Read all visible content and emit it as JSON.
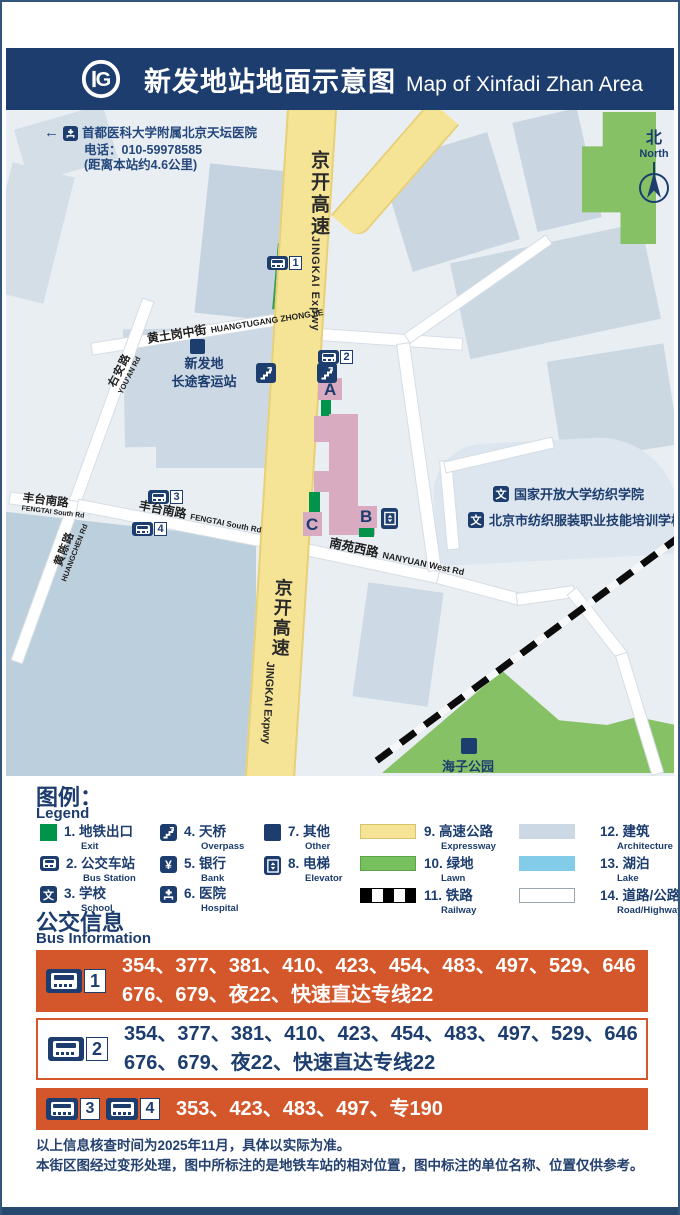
{
  "colors": {
    "navy": "#1c3d6e",
    "orange": "#d4562b",
    "expressway_yellow": "#f6e496",
    "lawn_green": "#76c05e",
    "exit_green": "#00944a",
    "building_gray": "#ccd8e3",
    "lake_blue": "#82cbe9",
    "station_pink": "#d9abc0"
  },
  "header": {
    "title_zh": "新发地站地面示意图",
    "title_en": "Map of Xinfadi Zhan Area",
    "logo": "beijing-subway-logo"
  },
  "map": {
    "info_box": {
      "line1": "首都医科大学附属北京天坛医院",
      "line2": "电话：010-59978585",
      "line3": "(距离本站约4.6公里)"
    },
    "north": {
      "zh": "北",
      "en": "North"
    },
    "expressway": {
      "zh": "京开高速",
      "en": "JINGKAI Expwy"
    },
    "roads": {
      "huangtugang": {
        "zh": "黄土岗中街",
        "en": "HUANGTUGANG ZHONGJIE"
      },
      "youan": {
        "zh": "右安路",
        "en": "YOU'AN Rd"
      },
      "fengtai": {
        "zh": "丰台南路",
        "en": "FENGTAI South Rd"
      },
      "huangchen": {
        "zh": "黄陈路",
        "en": "HUANGCHEN Rd"
      },
      "nanyuan": {
        "zh": "南苑西路",
        "en": "NANYUAN West Rd"
      }
    },
    "places": {
      "terminal_line1": "新发地",
      "terminal_line2": "长途客运站",
      "school1": "国家开放大学纺织学院",
      "school2": "北京市纺织服装职业技能培训学校",
      "park": "海子公园"
    },
    "exits": [
      "A",
      "B",
      "C"
    ],
    "bus_stops": [
      "1",
      "2",
      "3",
      "4"
    ]
  },
  "legend": {
    "title_zh": "图例：",
    "title_en": "Legend",
    "items": [
      {
        "num": "1.",
        "zh": "地铁出口",
        "en": "Exit"
      },
      {
        "num": "2.",
        "zh": "公交车站",
        "en": "Bus Station"
      },
      {
        "num": "3.",
        "zh": "学校",
        "en": "School"
      },
      {
        "num": "4.",
        "zh": "天桥",
        "en": "Overpass"
      },
      {
        "num": "5.",
        "zh": "银行",
        "en": "Bank"
      },
      {
        "num": "6.",
        "zh": "医院",
        "en": "Hospital"
      },
      {
        "num": "7.",
        "zh": "其他",
        "en": "Other"
      },
      {
        "num": "8.",
        "zh": "电梯",
        "en": "Elevator"
      },
      {
        "num": "9.",
        "zh": "高速公路",
        "en": "Expressway"
      },
      {
        "num": "10.",
        "zh": "绿地",
        "en": "Lawn"
      },
      {
        "num": "11.",
        "zh": "铁路",
        "en": "Railway"
      },
      {
        "num": "12.",
        "zh": "建筑",
        "en": "Architecture"
      },
      {
        "num": "13.",
        "zh": "湖泊",
        "en": "Lake"
      },
      {
        "num": "14.",
        "zh": "道路/公路",
        "en": "Road/Highway"
      }
    ]
  },
  "bus_info": {
    "title_zh": "公交信息",
    "title_en": "Bus Information",
    "rows": [
      {
        "icons": [
          "1"
        ],
        "lines": [
          "354、377、381、410、423、454、483、497、529、646",
          "676、679、夜22、快速直达专线22"
        ]
      },
      {
        "icons": [
          "2"
        ],
        "lines": [
          "354、377、381、410、423、454、483、497、529、646",
          "676、679、夜22、快速直达专线22"
        ]
      },
      {
        "icons": [
          "3",
          "4"
        ],
        "lines": [
          "353、423、483、497、专190"
        ]
      }
    ]
  },
  "notes": [
    "以上信息核查时间为2025年11月，具体以实际为准。",
    "本街区图经过变形处理，图中所标注的是地铁车站的相对位置，图中标注的单位名称、位置仅供参考。"
  ]
}
